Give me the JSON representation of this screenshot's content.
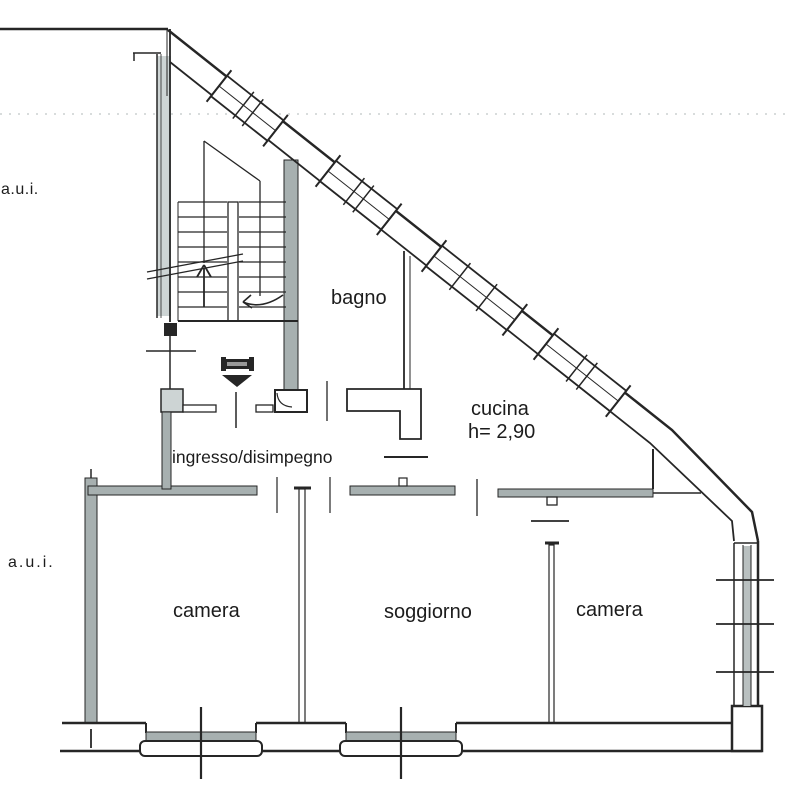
{
  "plan": {
    "labels": {
      "aui_top": "a.u.i.",
      "aui_bottom": "a.u.i.",
      "bagno": "bagno",
      "cucina": "cucina",
      "cucina_height": "h= 2,90",
      "ingresso": "ingresso/disimpegno",
      "camera_left": "camera",
      "soggiorno": "soggiorno",
      "camera_right": "camera"
    },
    "colors": {
      "line": "#262626",
      "wall_fill": "#a7b0b0",
      "light_wall_fill": "#cdd4d4",
      "background": "#ffffff"
    }
  }
}
